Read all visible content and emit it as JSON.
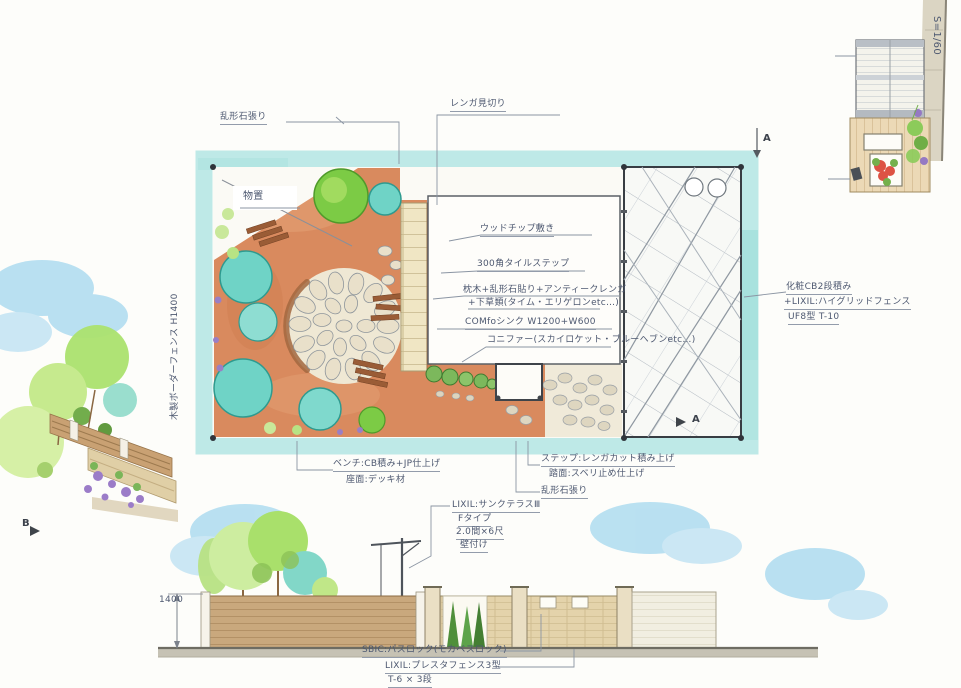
{
  "drawing": {
    "scale_label": "S=1/60",
    "plan": {
      "shed_label": "物置",
      "fence_left_vertical": "木製ボーダーフェンス H1400"
    },
    "markers": {
      "top_a": "A",
      "side_a": "A",
      "left_b": "B"
    },
    "notes": {
      "stone_paving_top": "乱形石張り",
      "brick_edging": "レンガ見切り",
      "wood_chip": "ウッドチップ敷き",
      "tile_step": "300角タイルステップ",
      "sleeper_line1": "枕木+乱形石貼り+アンティークレンガ",
      "sleeper_line2": "+下草類(タイム・エリゲロンetc…)",
      "sink": "COMfoシンク W1200+W600",
      "conifer": "コニファー(スカイロケット・ブルーヘブンetc…)",
      "cb_fence_line1": "化粧CB2段積み",
      "cb_fence_line2": "+LIXIL:ハイグリッドフェンス",
      "cb_fence_line3": "UF8型 T-10",
      "bench_line1": "ベンチ:CB積み+JP仕上げ",
      "bench_line2": "座面:デッキ材",
      "step_line1": "ステップ:レンガカット積み上げ",
      "step_line2": "踏面:スベリ止め仕上げ",
      "step_line3": "乱形石張り",
      "terrace_line1": "LIXIL:サンクテラスⅢ",
      "terrace_line2": "Fタイプ",
      "terrace_line3": "2.0間×6尺",
      "terrace_line4": "壁付け",
      "paving_product": "SBIC:パスロック(モカベスロック)",
      "fence_bottom_line1": "LIXIL:プレスタフェンス3型",
      "fence_bottom_line2": "T-6 × 3段",
      "dim_1400": "1400"
    },
    "colors": {
      "aqua_band": "#b7e7e4",
      "terracotta": "#d98a5e",
      "tree_turquoise": "#6fd3c6",
      "tree_green": "#7ccb45",
      "fence_tan": "#c9a87d",
      "brick_wall": "#e4d3ab",
      "cloud_blue": "#a9daef",
      "ink": "#4d5870"
    }
  }
}
